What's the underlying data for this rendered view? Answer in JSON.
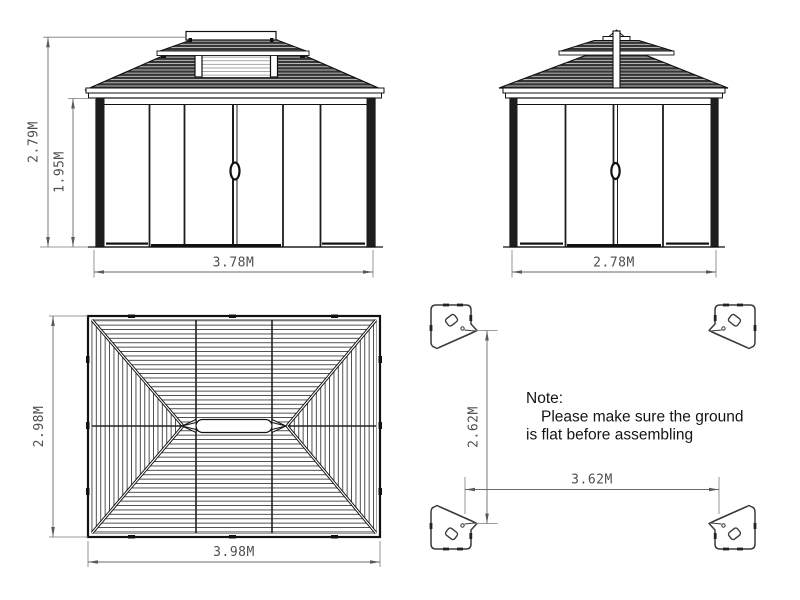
{
  "front_view": {
    "total_height": "2.79M",
    "wall_height": "1.95M",
    "width": "3.78M"
  },
  "side_view": {
    "width": "2.78M"
  },
  "roof_plan": {
    "depth": "2.98M",
    "width": "3.98M"
  },
  "footprint": {
    "depth": "2.62M",
    "width": "3.62M"
  },
  "note": {
    "heading": "Note:",
    "line1": "Please make sure the ground",
    "line2": "is flat before assembling"
  },
  "colors": {
    "line": "#1a1a1a",
    "dimension": "#6a6a6a",
    "roof_fill": "#363636"
  }
}
